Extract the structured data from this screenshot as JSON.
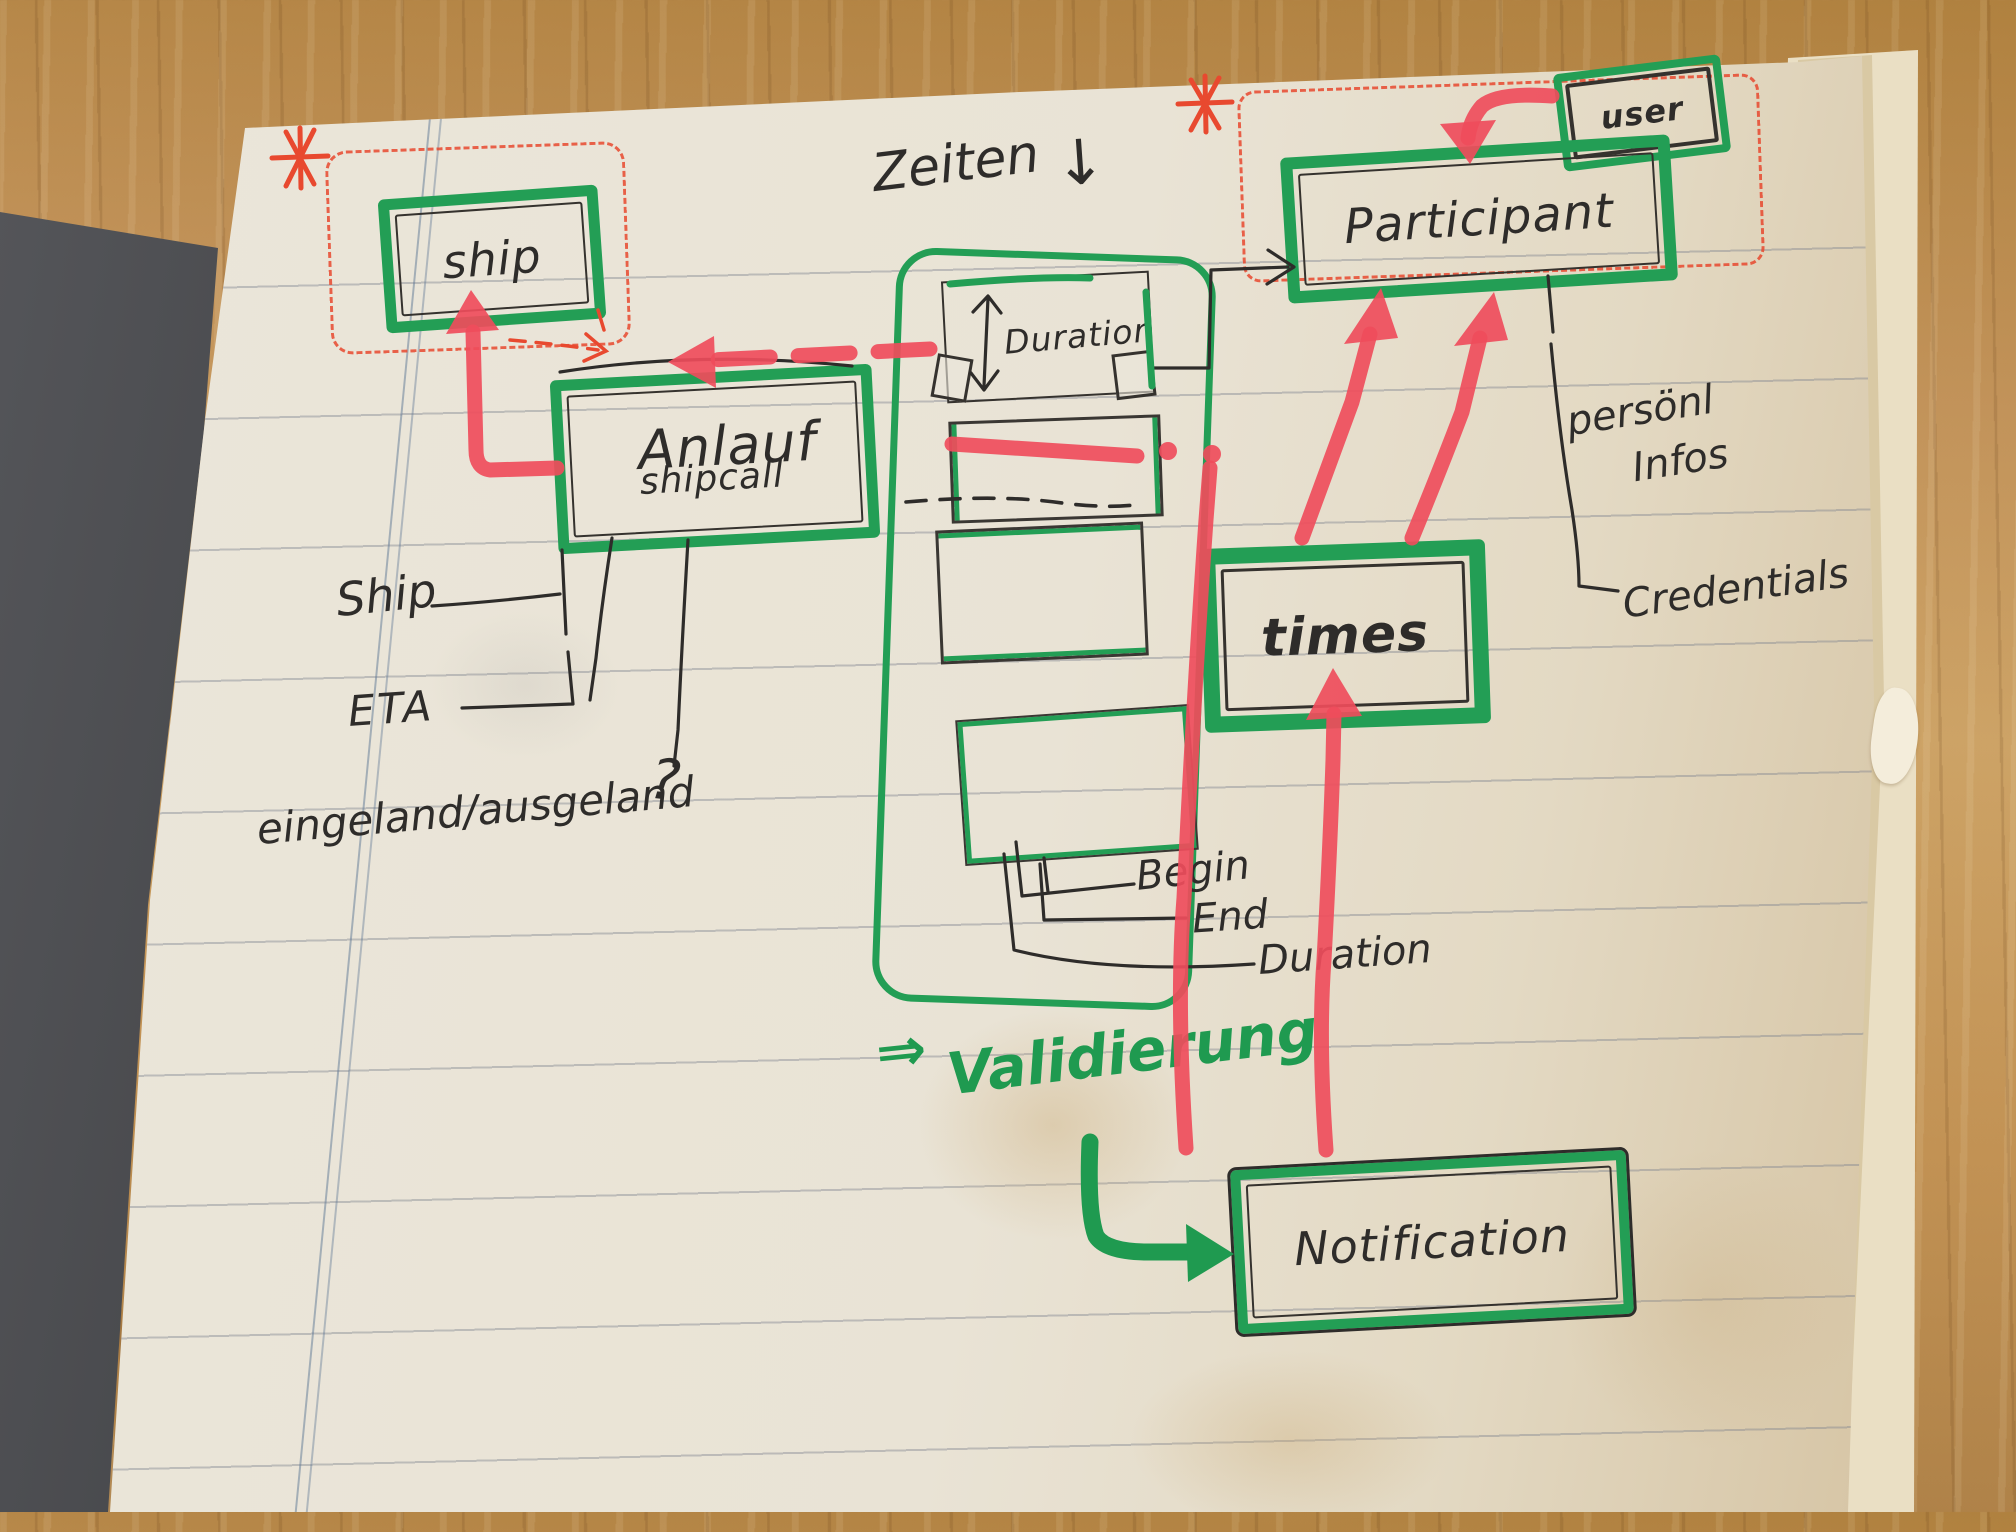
{
  "diagram": {
    "nodes": {
      "ship": "ship",
      "user": "user",
      "participant": "Participant",
      "anlauf": "Anlauf",
      "anlauf_sub": "shipcall",
      "duration_box": "Duration",
      "times": "times",
      "notification": "Notification"
    },
    "labels": {
      "zeiten": "Zeiten",
      "zeiten_arrow": "↓",
      "ship_attr": "Ship",
      "eta": "ETA",
      "inout": "eingeland/ausgeland",
      "question": "?",
      "begin": "Begin",
      "end": "End",
      "duration": "Duration",
      "personal": "persönl",
      "infos": "Infos",
      "credentials": "Credentials",
      "valid_arrow": "⇒",
      "validierung": "Validierung",
      "asterisk": "*"
    },
    "colors": {
      "marker_green": "#239e55",
      "marker_red": "#ef4d5c",
      "pen_red": "#e8492f",
      "ink": "#2e2c2a"
    }
  }
}
